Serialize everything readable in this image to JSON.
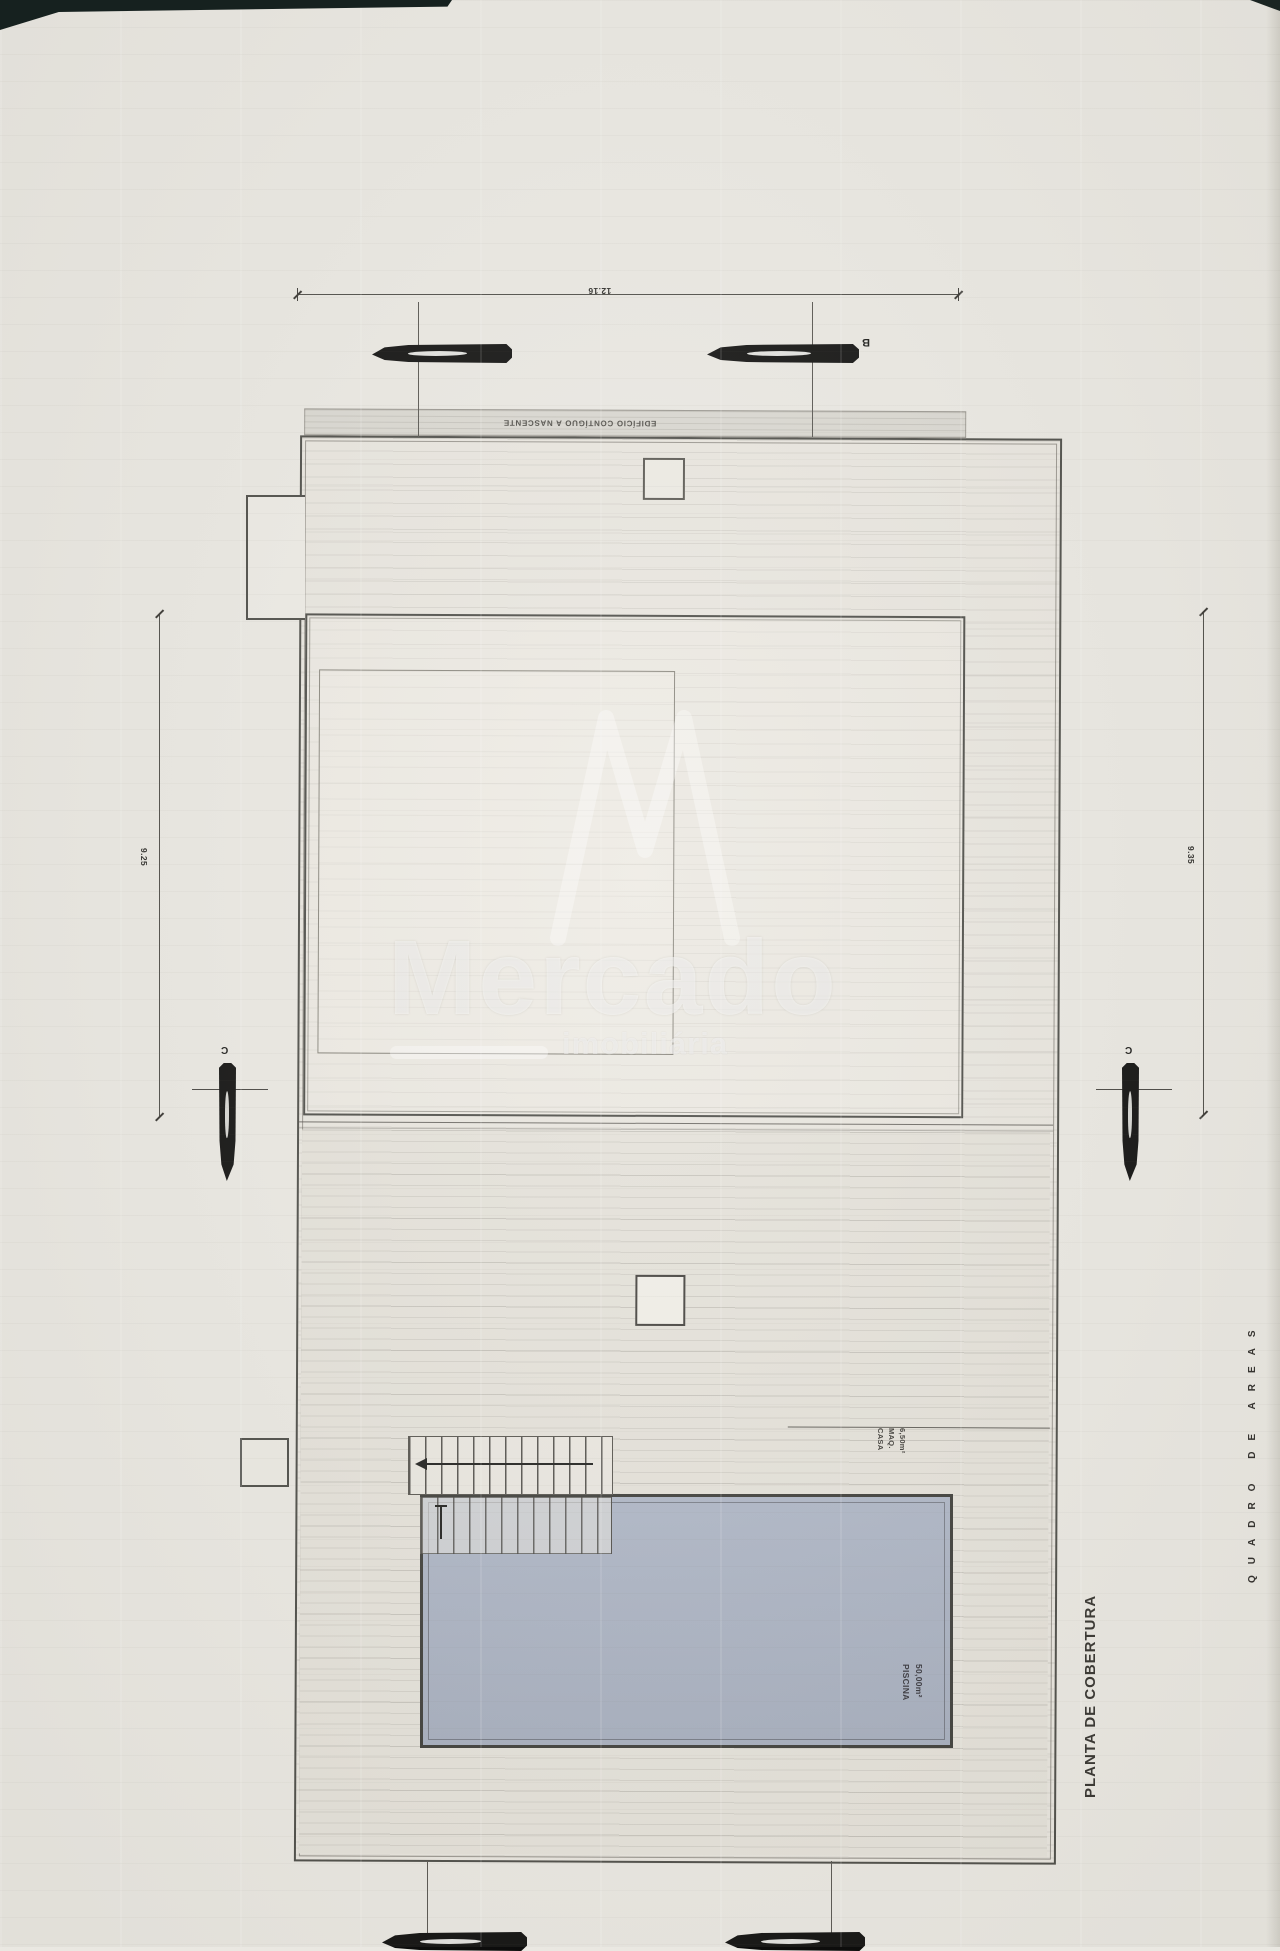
{
  "sheet": {
    "title": "PLANTA DE COBERTURA",
    "side_label": "QUADRO DE AREAS"
  },
  "dimensions": {
    "top": "12.16",
    "left": "9.25",
    "right": "9.35"
  },
  "labels": {
    "adjacent_building": "EDIFÍCIO CONTÍGUO A NASCENTE",
    "machine_house": {
      "line1": "CASA",
      "line2": "MAQ.",
      "line3": "6,50m²"
    },
    "pool": {
      "line1": "PISCINA",
      "line2": "50,00m²"
    }
  },
  "markers": {
    "section_b": "B",
    "section_c_left": "C",
    "section_c_right": "C"
  },
  "watermark": {
    "brand": "Mercado",
    "tagline": "imobiliária"
  },
  "colors": {
    "paper": "#eae8e2",
    "plan_fill": "#e8e5de",
    "terrace_fill": "#e4e1d9",
    "pool_fill": "#a9b1c1",
    "line": "#4a4a45",
    "band_fill": "#d9d7d0"
  }
}
